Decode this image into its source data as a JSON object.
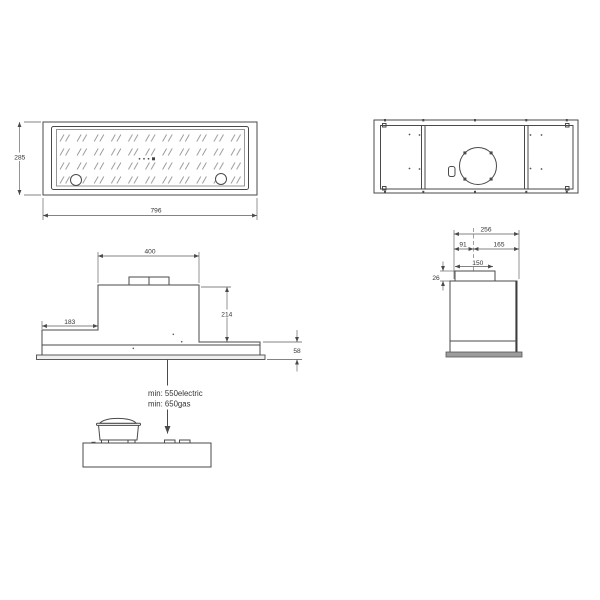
{
  "drawing": {
    "type": "cooker-hood-installation-drawing",
    "background": "#ffffff",
    "line_color": "#4a4a4a",
    "plate_fill": "#9c9c9c",
    "glass_fill": "#fcfcfc",
    "dims": {
      "front_height": "285",
      "front_width": "796",
      "side_depth": "256",
      "side_front_offset": "91",
      "side_rear_offset": "165",
      "duct_diameter": "150",
      "collar_height": "26",
      "elev_top_width": "400",
      "elev_body_height": "214",
      "elev_flange_width": "183",
      "elev_lower_height": "58"
    },
    "clearance": {
      "electric": "min: 550electric",
      "gas": "min: 650gas"
    }
  }
}
